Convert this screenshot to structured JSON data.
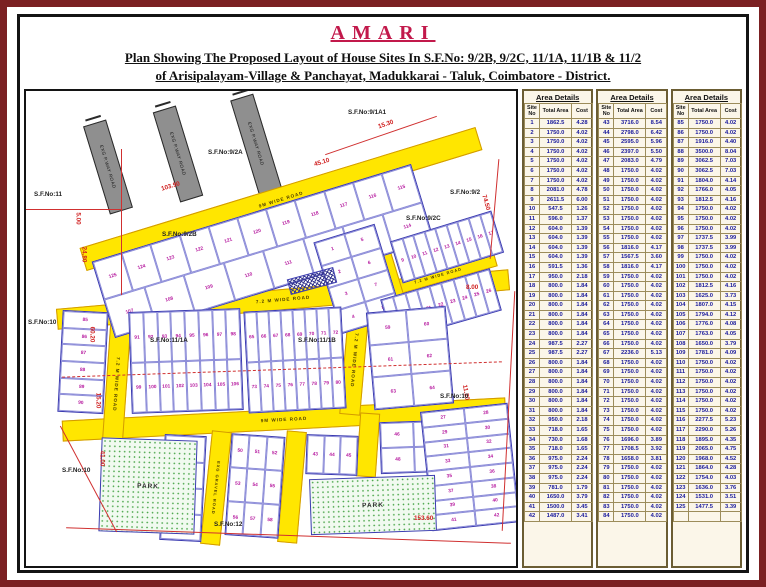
{
  "header": {
    "brand": "AMARI",
    "title_line1": "Plan Showing The Proposed Layout of House Sites In S.F.No: 9/2B, 9/2C, 11/1A, 11/1B & 11/2",
    "title_line2": "of  Arisipalayam-Village & Panchayat, Madukkarai - Taluk, Coimbatore - District."
  },
  "colors": {
    "brand_red": "#c2194b",
    "road_yellow": "#ffe600",
    "plot_number_magenta": "#b5179e",
    "boundary_red": "#d02020",
    "park_green": "#44a344",
    "table_text_blue": "#1a1a9c"
  },
  "map": {
    "labels": {
      "sf_9_2a": "S.F.No:9/2A",
      "sf_9_1a1": "S.F.No:9/1A1",
      "sf_11": "S.F.No:11",
      "sf_9_2": "S.F.No:9/2",
      "sf_9_2b": "S.F.No:9/2B",
      "sf_9_2c": "S.F.No:9/2C",
      "sf_11_1a": "S.F.No:11/1A",
      "sf_11_1b": "S.F.No:11/1B",
      "sf_10": "S.F.No:10",
      "sf_12": "S.F.No:12",
      "park": "PARK",
      "road_9m": "9M WIDE ROAD",
      "road_72": "7.2 M WIDE ROAD",
      "road_gravel": "EXG GRAVEL ROAD",
      "road_exg": "EXG P.WAY ROAD"
    },
    "dims": {
      "d1": "103.90",
      "d2": "15.30",
      "d3": "45.10",
      "d4": "74.50",
      "d5": "8.00",
      "d6": "11.20",
      "d7": "5.00",
      "d8": "24.80",
      "d9": "60.20",
      "d10": "15.20",
      "d11": "41.00",
      "d12": "153.60"
    },
    "plot_blocks": {
      "band_top": [
        [
          125,
          124,
          123,
          122,
          121,
          120,
          119,
          118,
          117,
          116,
          115
        ],
        [
          107,
          108,
          109,
          110,
          111,
          112,
          113,
          114
        ]
      ],
      "block_ne": [
        [
          1,
          5
        ],
        [
          2,
          6
        ],
        [
          3,
          7
        ],
        [
          4,
          8
        ]
      ],
      "strip_a": [
        [
          9,
          10,
          11,
          12,
          13,
          14,
          15,
          16,
          17
        ]
      ],
      "strip_b": [
        [
          18,
          19,
          20,
          21,
          22,
          23,
          24,
          25,
          26
        ]
      ],
      "mid_left": [
        [
          85
        ],
        [
          86
        ],
        [
          87
        ],
        [
          88
        ],
        [
          89
        ],
        [
          90
        ]
      ],
      "mid_a": [
        [
          91,
          92,
          93,
          94,
          95,
          96,
          97,
          98
        ],
        [
          99,
          100,
          101,
          102,
          103,
          104,
          105,
          106
        ]
      ],
      "mid_b": [
        [
          65,
          66,
          67,
          68,
          69,
          70,
          71,
          72
        ],
        [
          73,
          74,
          75,
          76,
          77,
          78,
          79,
          80
        ]
      ],
      "mid_right": [
        [
          59,
          60
        ],
        [
          61,
          62
        ],
        [
          63,
          64
        ]
      ],
      "bot_left": [
        [
          81
        ],
        [
          82
        ],
        [
          83
        ],
        [
          84
        ]
      ],
      "bot_a": [
        [
          50,
          51,
          52
        ],
        [
          53,
          54,
          55
        ],
        [
          56,
          57,
          58
        ]
      ],
      "bot_b": [
        [
          43,
          44,
          45
        ]
      ],
      "bot_c": [
        [
          46,
          47
        ],
        [
          48,
          49
        ]
      ],
      "bot_right": [
        [
          27,
          28
        ],
        [
          29,
          30
        ],
        [
          31,
          32
        ],
        [
          33,
          34
        ],
        [
          35,
          36
        ],
        [
          37,
          38
        ],
        [
          39,
          40
        ],
        [
          41,
          42
        ]
      ]
    }
  },
  "area_tables": {
    "title": "Area Details",
    "columns": [
      "Site No",
      "Total Area",
      "Cost"
    ],
    "tables": [
      [
        [
          1,
          "1862.5",
          "4.28"
        ],
        [
          2,
          "1750.0",
          "4.02"
        ],
        [
          3,
          "1750.0",
          "4.02"
        ],
        [
          4,
          "1750.0",
          "4.02"
        ],
        [
          5,
          "1750.0",
          "4.02"
        ],
        [
          6,
          "1750.0",
          "4.02"
        ],
        [
          7,
          "1750.0",
          "4.02"
        ],
        [
          8,
          "2081.0",
          "4.78"
        ],
        [
          9,
          "2611.5",
          "6.00"
        ],
        [
          10,
          "547.5",
          "1.26"
        ],
        [
          11,
          "596.0",
          "1.37"
        ],
        [
          12,
          "604.0",
          "1.39"
        ],
        [
          13,
          "604.0",
          "1.39"
        ],
        [
          14,
          "604.0",
          "1.39"
        ],
        [
          15,
          "604.0",
          "1.39"
        ],
        [
          16,
          "591.5",
          "1.36"
        ],
        [
          17,
          "950.0",
          "2.18"
        ],
        [
          18,
          "800.0",
          "1.84"
        ],
        [
          19,
          "800.0",
          "1.84"
        ],
        [
          20,
          "800.0",
          "1.84"
        ],
        [
          21,
          "800.0",
          "1.84"
        ],
        [
          22,
          "800.0",
          "1.84"
        ],
        [
          23,
          "800.0",
          "1.84"
        ],
        [
          24,
          "987.5",
          "2.27"
        ],
        [
          25,
          "987.5",
          "2.27"
        ],
        [
          26,
          "800.0",
          "1.84"
        ],
        [
          27,
          "800.0",
          "1.84"
        ],
        [
          28,
          "800.0",
          "1.84"
        ],
        [
          29,
          "800.0",
          "1.84"
        ],
        [
          30,
          "800.0",
          "1.84"
        ],
        [
          31,
          "800.0",
          "1.84"
        ],
        [
          32,
          "950.0",
          "2.18"
        ],
        [
          33,
          "718.0",
          "1.65"
        ],
        [
          34,
          "730.0",
          "1.68"
        ],
        [
          35,
          "718.0",
          "1.65"
        ],
        [
          36,
          "975.0",
          "2.24"
        ],
        [
          37,
          "975.0",
          "2.24"
        ],
        [
          38,
          "975.0",
          "2.24"
        ],
        [
          39,
          "781.0",
          "1.79"
        ],
        [
          40,
          "1650.0",
          "3.79"
        ],
        [
          41,
          "1500.0",
          "3.45"
        ],
        [
          42,
          "1487.0",
          "3.41"
        ]
      ],
      [
        [
          43,
          "3716.0",
          "8.54"
        ],
        [
          44,
          "2798.0",
          "6.42"
        ],
        [
          45,
          "2595.0",
          "5.96"
        ],
        [
          46,
          "2397.0",
          "5.50"
        ],
        [
          47,
          "2083.0",
          "4.79"
        ],
        [
          48,
          "1750.0",
          "4.02"
        ],
        [
          49,
          "1750.0",
          "4.02"
        ],
        [
          50,
          "1750.0",
          "4.02"
        ],
        [
          51,
          "1750.0",
          "4.02"
        ],
        [
          52,
          "1750.0",
          "4.02"
        ],
        [
          53,
          "1750.0",
          "4.02"
        ],
        [
          54,
          "1750.0",
          "4.02"
        ],
        [
          55,
          "1750.0",
          "4.02"
        ],
        [
          56,
          "1816.0",
          "4.17"
        ],
        [
          57,
          "1567.5",
          "3.60"
        ],
        [
          58,
          "1816.0",
          "4.17"
        ],
        [
          59,
          "1750.0",
          "4.02"
        ],
        [
          60,
          "1750.0",
          "4.02"
        ],
        [
          61,
          "1750.0",
          "4.02"
        ],
        [
          62,
          "1750.0",
          "4.02"
        ],
        [
          63,
          "1750.0",
          "4.02"
        ],
        [
          64,
          "1750.0",
          "4.02"
        ],
        [
          65,
          "1750.0",
          "4.02"
        ],
        [
          66,
          "1750.0",
          "4.02"
        ],
        [
          67,
          "2236.0",
          "5.13"
        ],
        [
          68,
          "1750.0",
          "4.02"
        ],
        [
          69,
          "1750.0",
          "4.02"
        ],
        [
          70,
          "1750.0",
          "4.02"
        ],
        [
          71,
          "1750.0",
          "4.02"
        ],
        [
          72,
          "1750.0",
          "4.02"
        ],
        [
          73,
          "1750.0",
          "4.02"
        ],
        [
          74,
          "1750.0",
          "4.02"
        ],
        [
          75,
          "1750.0",
          "4.02"
        ],
        [
          76,
          "1696.0",
          "3.89"
        ],
        [
          77,
          "1708.5",
          "3.92"
        ],
        [
          78,
          "1658.0",
          "3.81"
        ],
        [
          79,
          "1750.0",
          "4.02"
        ],
        [
          80,
          "1750.0",
          "4.02"
        ],
        [
          81,
          "1750.0",
          "4.02"
        ],
        [
          82,
          "1750.0",
          "4.02"
        ],
        [
          83,
          "1750.0",
          "4.02"
        ],
        [
          84,
          "1750.0",
          "4.02"
        ]
      ],
      [
        [
          85,
          "1750.0",
          "4.02"
        ],
        [
          86,
          "1750.0",
          "4.02"
        ],
        [
          87,
          "1916.0",
          "4.40"
        ],
        [
          88,
          "3500.0",
          "8.04"
        ],
        [
          89,
          "3062.5",
          "7.03"
        ],
        [
          90,
          "3062.5",
          "7.03"
        ],
        [
          91,
          "1804.0",
          "4.14"
        ],
        [
          92,
          "1766.0",
          "4.05"
        ],
        [
          93,
          "1812.5",
          "4.16"
        ],
        [
          94,
          "1750.0",
          "4.02"
        ],
        [
          95,
          "1750.0",
          "4.02"
        ],
        [
          96,
          "1750.0",
          "4.02"
        ],
        [
          97,
          "1737.5",
          "3.99"
        ],
        [
          98,
          "1737.5",
          "3.99"
        ],
        [
          99,
          "1750.0",
          "4.02"
        ],
        [
          100,
          "1750.0",
          "4.02"
        ],
        [
          101,
          "1750.0",
          "4.02"
        ],
        [
          102,
          "1812.5",
          "4.16"
        ],
        [
          103,
          "1625.0",
          "3.73"
        ],
        [
          104,
          "1807.0",
          "4.15"
        ],
        [
          105,
          "1794.0",
          "4.12"
        ],
        [
          106,
          "1776.0",
          "4.08"
        ],
        [
          107,
          "1763.0",
          "4.05"
        ],
        [
          108,
          "1650.0",
          "3.79"
        ],
        [
          109,
          "1781.0",
          "4.09"
        ],
        [
          110,
          "1750.0",
          "4.02"
        ],
        [
          111,
          "1750.0",
          "4.02"
        ],
        [
          112,
          "1750.0",
          "4.02"
        ],
        [
          113,
          "1750.0",
          "4.02"
        ],
        [
          114,
          "1750.0",
          "4.02"
        ],
        [
          115,
          "1750.0",
          "4.02"
        ],
        [
          116,
          "2277.5",
          "5.23"
        ],
        [
          117,
          "2290.0",
          "5.26"
        ],
        [
          118,
          "1895.0",
          "4.35"
        ],
        [
          119,
          "2065.0",
          "4.75"
        ],
        [
          120,
          "1968.0",
          "4.52"
        ],
        [
          121,
          "1864.0",
          "4.28"
        ],
        [
          122,
          "1754.0",
          "4.03"
        ],
        [
          123,
          "1636.0",
          "3.76"
        ],
        [
          124,
          "1531.0",
          "3.51"
        ],
        [
          125,
          "1477.5",
          "3.39"
        ],
        [
          "",
          "",
          ""
        ]
      ]
    ]
  }
}
